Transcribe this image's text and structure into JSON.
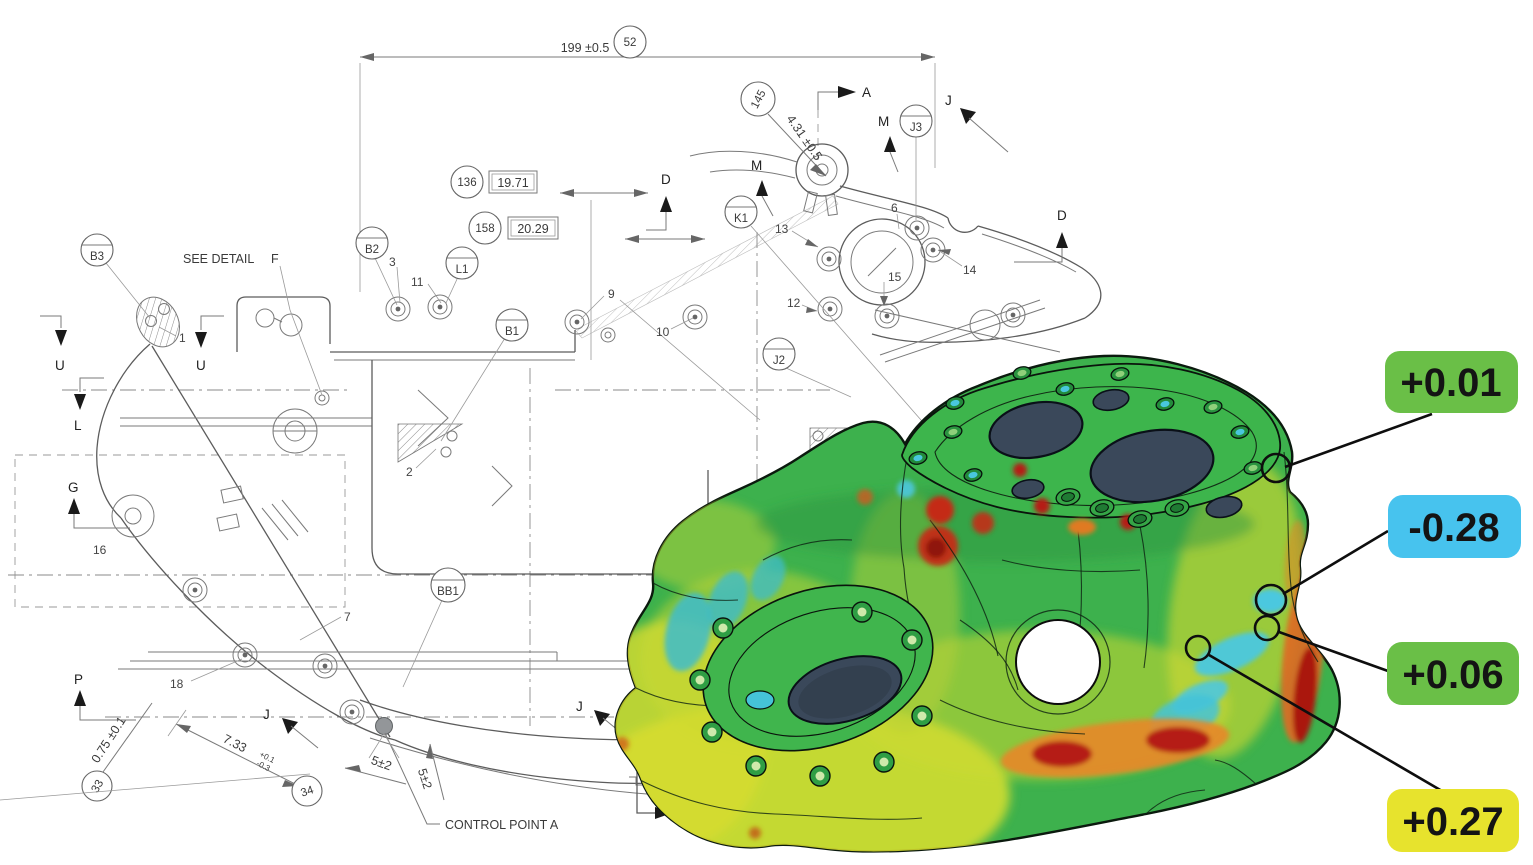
{
  "deviation_labels": [
    {
      "value": "+0.01",
      "bg": "#6abf47"
    },
    {
      "value": "-0.28",
      "bg": "#47c3ee"
    },
    {
      "value": "+0.06",
      "bg": "#6abf47"
    },
    {
      "value": "+0.27",
      "bg": "#e7e32d"
    }
  ],
  "heatmap_palette": {
    "nominal_green": "#3db14d",
    "positive_yellow": "#d9dd2c",
    "high_orange": "#e07a22",
    "max_red": "#b01d10",
    "negative_cyan": "#41bfdd",
    "bore_slate": "#3a485a"
  },
  "drawing": {
    "dim_overall": "199 ±0.5",
    "dim_angled": "4.31 ±0.5",
    "dim_boxed_1": "19.71",
    "dim_boxed_2": "20.29",
    "dim_offset": "0.75 ±0.1",
    "dim_depth": "7.33",
    "dim_depth_tol_upper": "+0.1",
    "dim_depth_tol_lower": "-0.3",
    "dim_gap_1": "5±2",
    "dim_gap_2": "5±2",
    "note_see_detail": "SEE DETAIL",
    "note_detail_ref": "F",
    "note_control_point": "CONTROL POINT A",
    "balloons": {
      "b52": "52",
      "b145": "145",
      "b136": "136",
      "b158": "158",
      "b33": "33",
      "b34": "34",
      "B3": "B3",
      "B2": "B2",
      "L1": "L1",
      "B1": "B1",
      "K1": "K1",
      "J3": "J3",
      "J2": "J2",
      "BB1": "BB1"
    },
    "items": {
      "i1": "1",
      "i2": "2",
      "i3": "3",
      "i5": "5",
      "i6": "6",
      "i7": "7",
      "i9": "9",
      "i10": "10",
      "i11": "11",
      "i12": "12",
      "i13": "13",
      "i14": "14",
      "i15": "15",
      "i16": "16",
      "i18": "18"
    },
    "views": {
      "A": "A",
      "M1": "M",
      "M2": "M",
      "Jtop": "J",
      "D1": "D",
      "D2": "D",
      "U1": "U",
      "U2": "U",
      "L": "L",
      "G": "G",
      "P": "P",
      "Jbot1": "J",
      "Jbot2": "J"
    }
  }
}
